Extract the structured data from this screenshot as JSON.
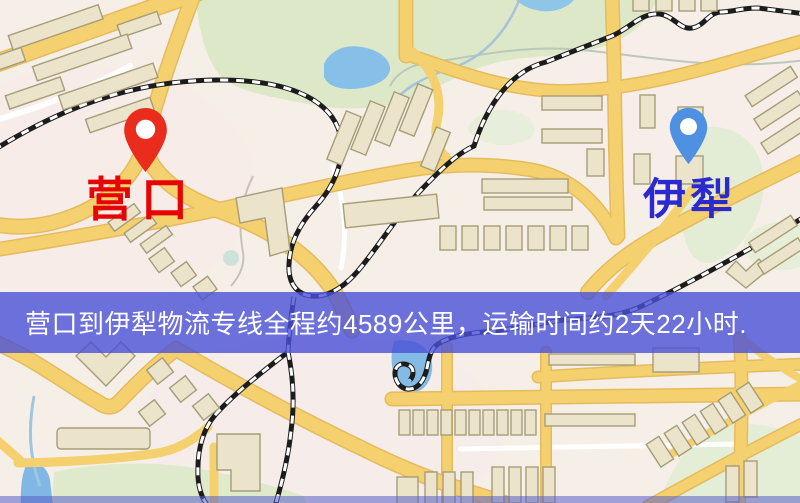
{
  "markers": {
    "origin": {
      "label": "营口",
      "pin_icon": "red-map-pin",
      "pin_color": "#ea2c1d",
      "label_color": "#e60505"
    },
    "destination": {
      "label": "伊犁",
      "pin_icon": "blue-map-pin",
      "pin_color": "#4e90e2",
      "label_color": "#2a2ad0"
    }
  },
  "banner": {
    "text": "营口到伊犁物流专线全程约4589公里，运输时间约2天22小时.",
    "origin": "营口",
    "destination": "伊犁",
    "distance": "约4589公里",
    "duration": "约2天22小时",
    "bg_color": "rgba(74,80,215,0.8)",
    "text_color": "#ffffff"
  },
  "palette": {
    "background": "#f6efe8",
    "road": "#f5d06e",
    "road_edge": "#e5bb5e",
    "park_green": "#dde8c8",
    "water_blue": "#86bfe7",
    "building": "#ece3cb",
    "building_outline": "#a69d78",
    "railway": "#1c1c1c"
  }
}
